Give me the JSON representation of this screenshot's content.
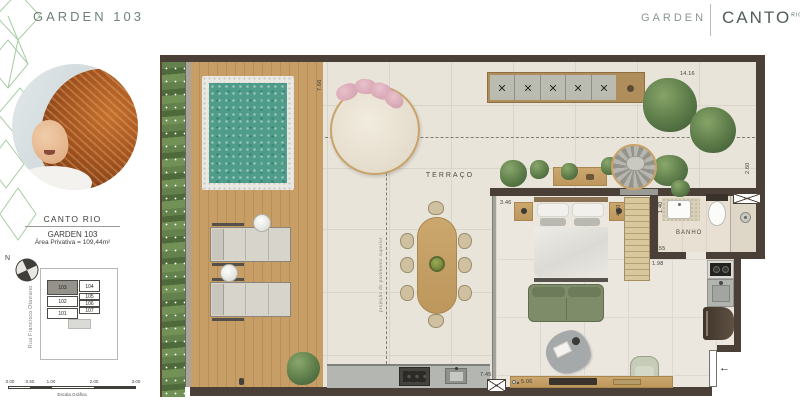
{
  "header": {
    "left_title": "GARDEN 103",
    "right_section": "GARDEN",
    "brand": "CANTO",
    "brand_sup": "RIO"
  },
  "sidebar": {
    "brand_title": "CANTO RIO",
    "unit_title": "GARDEN 103",
    "area_line": "Área Privativa = 109,44m²",
    "north_label": "N",
    "street_label": "Rua Francisco Otaviano",
    "keyplan": {
      "cells": [
        {
          "label": "103",
          "selected": true
        },
        {
          "label": "104",
          "selected": false
        },
        {
          "label": "102",
          "selected": false
        },
        {
          "label": "105",
          "selected": false
        },
        {
          "label": "106",
          "selected": false
        },
        {
          "label": "101",
          "selected": false
        },
        {
          "label": "107",
          "selected": false
        }
      ]
    },
    "scale_bar": {
      "ticks": [
        "0.00",
        "0.50",
        "1.00",
        "2.00",
        "3.00"
      ],
      "caption": "Escala Gráfica"
    }
  },
  "plan": {
    "labels": {
      "terrace": "TERRAÇO",
      "bathroom": "BANHO",
      "projection": "projeção do pavimento superior",
      "entry_arrow": "←"
    },
    "dims": {
      "pool_height": "7.66",
      "terrace_width": "14.16",
      "terrace_depth": "2.60",
      "bedroom_left": "3.46",
      "bedroom_right": "4.70",
      "bath_width": "1.40",
      "bath_depth": "2.55",
      "kitchen_width": "1.98",
      "living_height": "7.45",
      "living_width": "5.06"
    }
  },
  "colors": {
    "accent_pattern": "#a7cda3",
    "header_text": "#6e7f7e",
    "wall": "#4b4037",
    "pool_water": "#4f9c8a",
    "deck_wood": "#c49e67",
    "terrace_tile": "#e8e4da",
    "sofa_green": "#7d8a68",
    "pillow_pink": "#ddafbb"
  }
}
